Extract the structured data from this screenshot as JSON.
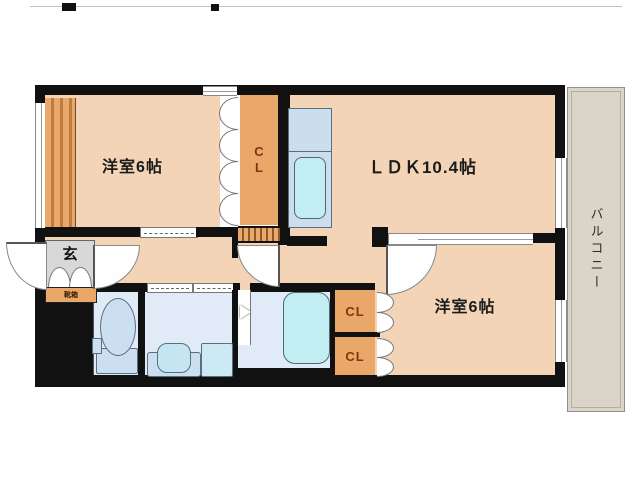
{
  "plan": {
    "title": "apartment-floor-plan",
    "rooms": {
      "bedroom1": {
        "label": "洋室6帖"
      },
      "ldk": {
        "label": "ＬＤＫ10.4帖"
      },
      "bedroom2": {
        "label": "洋室6帖"
      },
      "balcony": {
        "label": "バルコニー"
      },
      "entrance": {
        "label": "玄"
      },
      "shoe_cabinet": {
        "label": "靴箱"
      },
      "closet_top": {
        "label": "CL"
      },
      "closet_mid": {
        "label": "CL"
      },
      "closet_bottom": {
        "label": "CL"
      }
    },
    "colors": {
      "room_fill": "#f3d4b6",
      "closet_fill": "#e9a76a",
      "closet_text": "#7b3a0e",
      "balcony_fill": "#dbd5c9",
      "entrance_fill": "#d8d8d8",
      "wet_area_fill": "#e1ebf7",
      "fixture_fill": "#cbdff0",
      "tub_fill": "#c2eef3",
      "wall": "#111111"
    }
  }
}
